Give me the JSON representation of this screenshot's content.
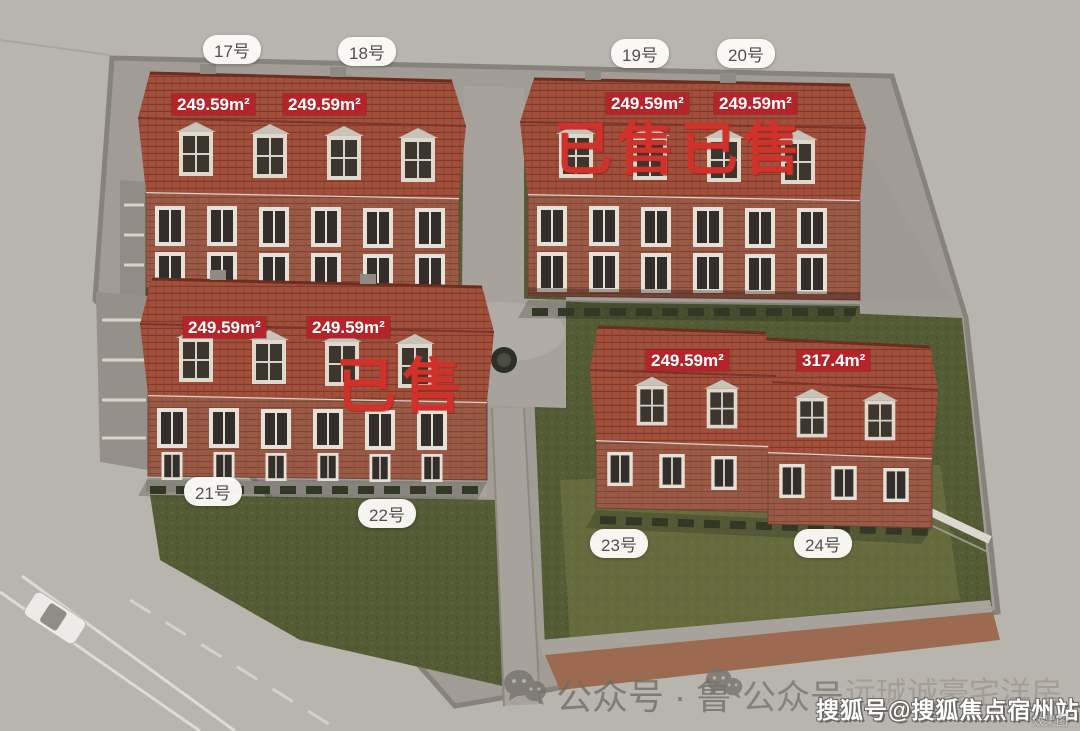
{
  "pills": [
    "17号",
    "18号",
    "19号",
    "20号",
    "21号",
    "22号",
    "23号",
    "24号"
  ],
  "badges": [
    "249.59m²",
    "249.59m²",
    "249.59m²",
    "249.59m²",
    "249.59m²",
    "249.59m²",
    "249.59m²",
    "317.4m²"
  ],
  "sold": {
    "top_right": "已售已售",
    "center_left": "已售"
  },
  "watermark": {
    "part1": "公众号 · 鲁",
    "part2": "公众号",
    "part3": "远珹诚豪宅洋房"
  },
  "credit": {
    "publisher": "搜狐号@搜狐焦点宿州站",
    "note": "效果图"
  },
  "colors": {
    "sold_red": "#d0312a",
    "badge_red": "#b3252a",
    "pill_text": "#52504d",
    "roof_tile": "#a24f3b",
    "lawn_green": "#535b35",
    "ground_gray": "#b8b4ae"
  }
}
